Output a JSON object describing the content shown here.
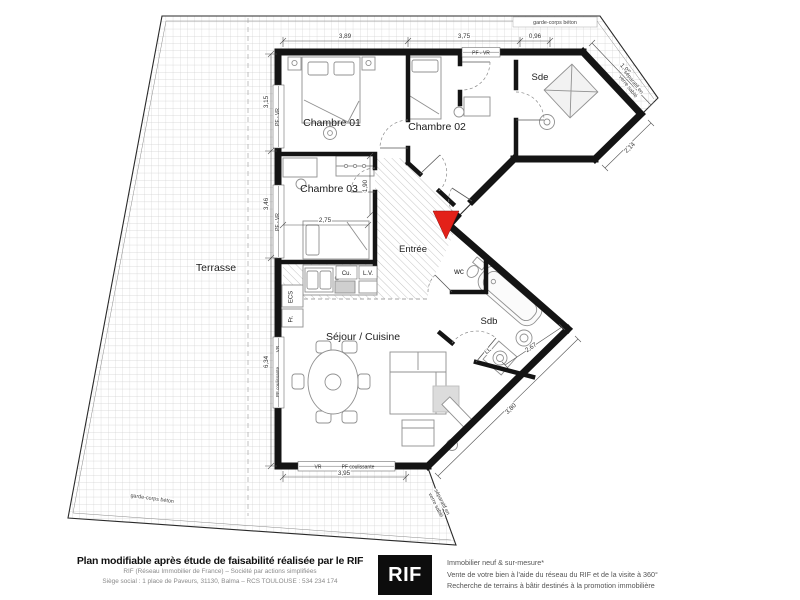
{
  "plan": {
    "rooms": {
      "terrasse": "Terrasse",
      "chambre01": "Chambre 01",
      "chambre02": "Chambre 02",
      "chambre03": "Chambre 03",
      "sde": "Sde",
      "entree": "Entrée",
      "wc": "wc",
      "sdb": "Sdb",
      "sejour": "Séjour / Cuisine"
    },
    "fixtures": {
      "cu": "Cu.",
      "lv": "L.V.",
      "ecs": "ECS",
      "fr": "Fr.",
      "ll": "LL"
    },
    "dimensions": {
      "top_left": "3,89",
      "top_mid": "3,75",
      "top_right": "0,96",
      "diag_ne": "1,99",
      "diag_sde": "2,14",
      "left_upper": "3,15",
      "left_mid": "3,46",
      "left_lower": "6,34",
      "chambre03_width": "2,75",
      "chambre03_door": "1,90",
      "sdb_diag": "2,67",
      "diag_se": "3,80",
      "bottom": "3,95"
    },
    "openings": {
      "pf_vr": "PF - VR",
      "vr": "VR",
      "pf_coulissante": "PF coulissante"
    },
    "edge_labels": {
      "garde_corps": "garde-corps béton",
      "separatif_line1": "séparatif en",
      "separatif_line2": "verre sablé"
    },
    "colors": {
      "wall": "#141414",
      "entry_marker": "#e32119"
    }
  },
  "footer": {
    "left_title": "Plan modifiable après étude de faisabilité réalisée par le RIF",
    "left_line2": "RIF (Réseau Immobilier de France) – Société par actions simplifiées",
    "left_line3": "Siège social : 1 place de Paveurs, 31130, Balma – RCS TOULOUSE : 534 234 174",
    "logo": "RIF",
    "right_line1": "Immobilier neuf & sur-mesure*",
    "right_line2": "Vente de votre bien à l'aide du réseau du RIF et de la visite à 360°",
    "right_line3": "Recherche de terrains à bâtir destinés à la promotion immobilière"
  }
}
